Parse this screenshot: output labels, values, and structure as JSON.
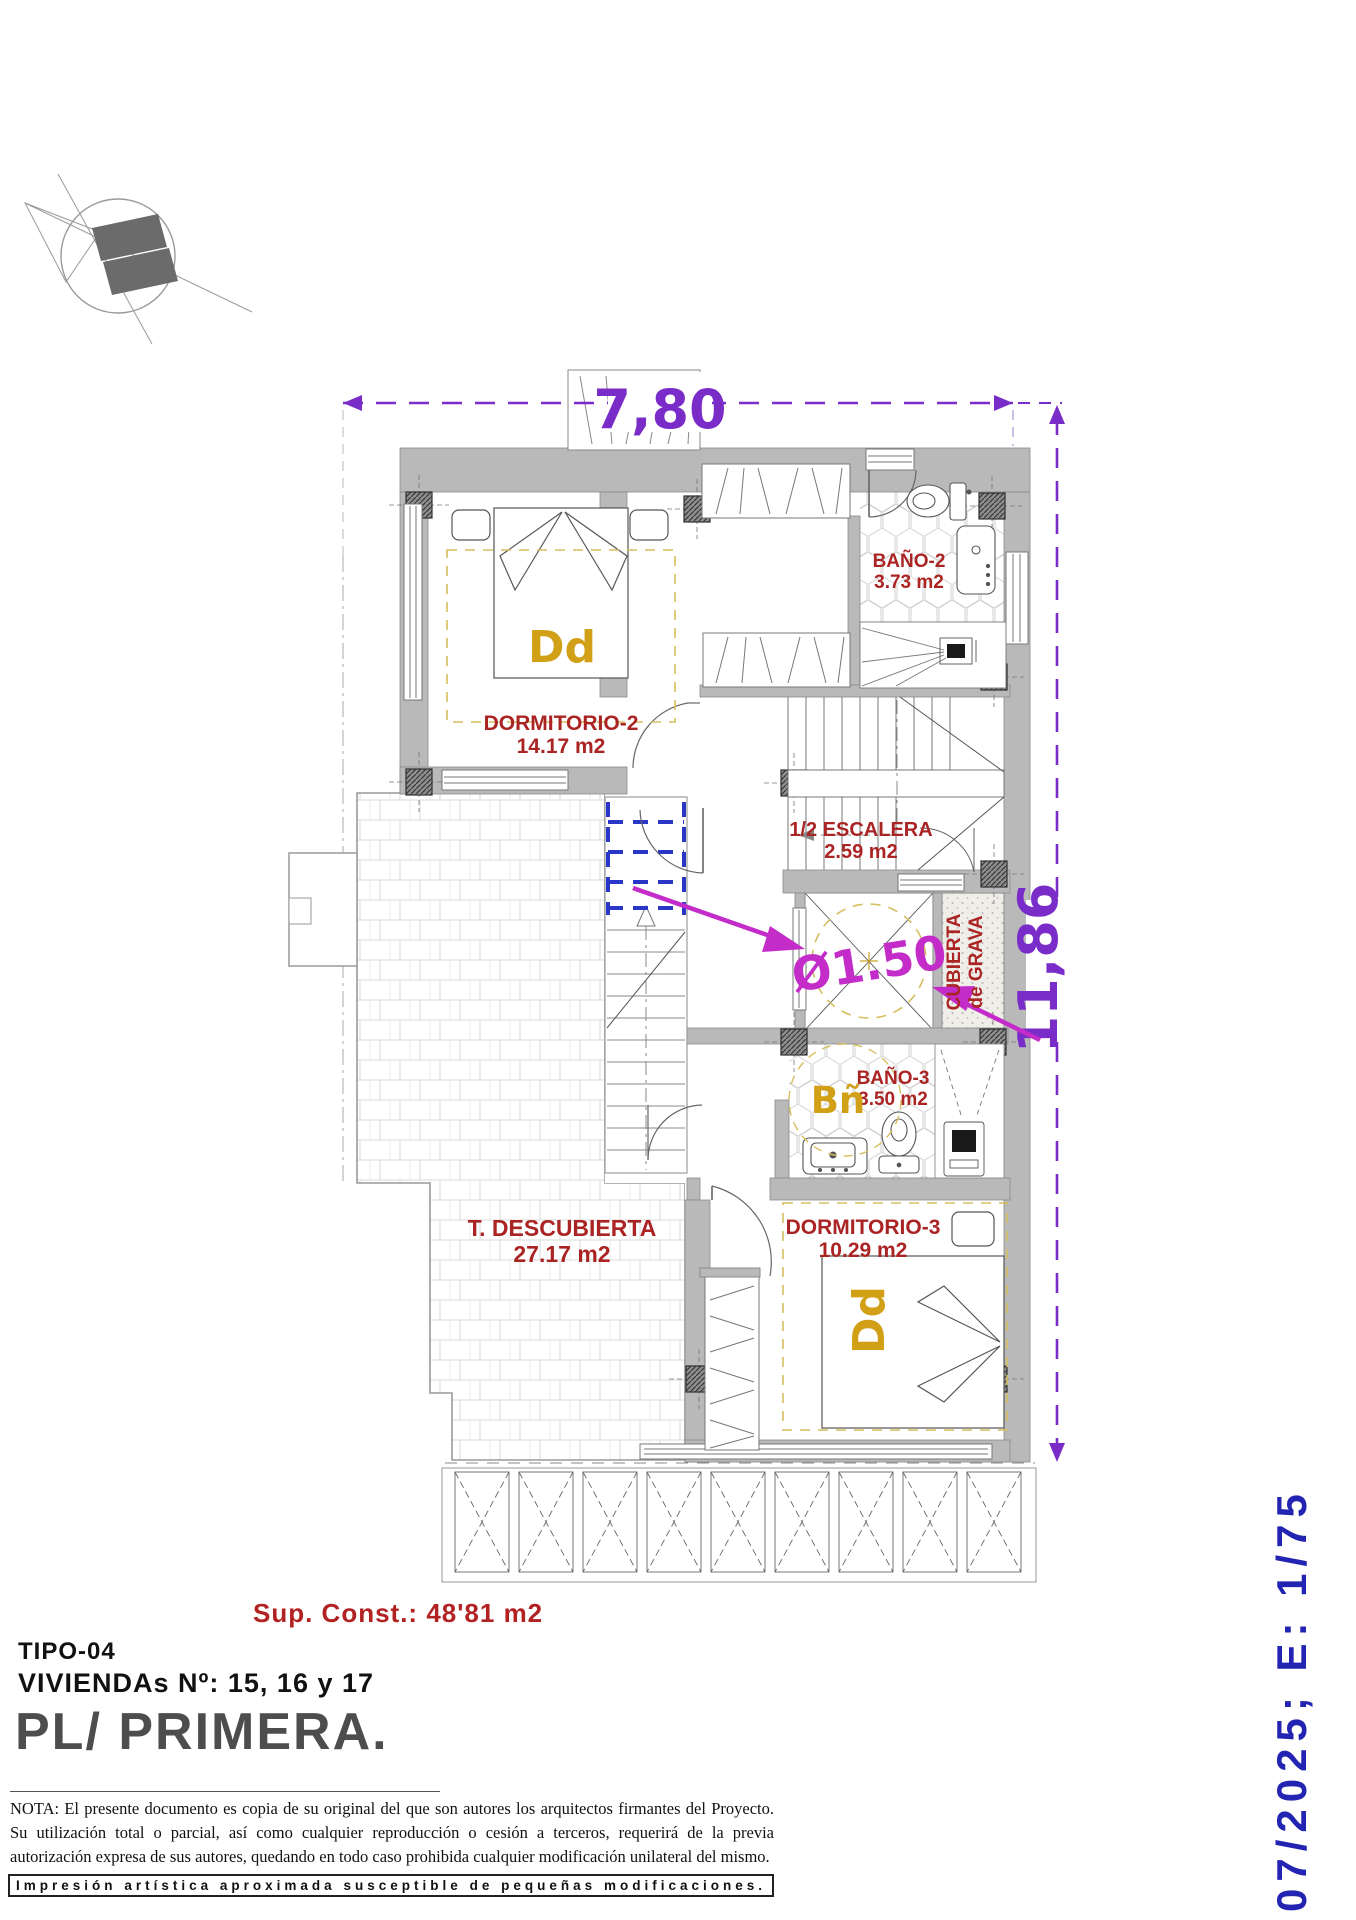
{
  "dimensions": {
    "width": "7,80",
    "height": "11,86",
    "patio_diameter": "Ø1.50"
  },
  "rooms": {
    "dormitorio2": {
      "name": "DORMITORIO-2",
      "area": "14.17 m2",
      "tag": "Dd"
    },
    "bano2": {
      "name": "BAÑO-2",
      "area": "3.73 m2"
    },
    "escalera": {
      "name": "1/2 ESCALERA",
      "area": "2.59 m2"
    },
    "cubierta": {
      "line1": "CUBIERTA",
      "line2": "de GRAVA"
    },
    "bano3": {
      "name": "BAÑO-3",
      "area": "3.50 m2",
      "tag": "Bñ"
    },
    "dormitorio3": {
      "name": "DORMITORIO-3",
      "area": "10.29 m2",
      "tag": "Dd"
    },
    "terraza": {
      "name": "T. DESCUBIERTA",
      "area": "27.17 m2"
    }
  },
  "titleblock": {
    "sup_const": "Sup. Const.: 48'81 m2",
    "tipo": "TIPO-04",
    "viviendas": "VIVIENDAs Nº: 15, 16 y 17",
    "planta": "PL/ PRIMERA.",
    "date_scale": "07/2025; E: 1/75"
  },
  "nota": "NOTA: El presente documento es copia de su original del que son autores los arquitectos firmantes del Proyecto. Su utilización total o parcial, así como cualquier reproducción o cesión a terceros, requerirá  de la previa autorización expresa de sus autores, quedando en todo caso prohibida cualquier modificación unilateral del mismo.",
  "disclaimer": "Impresión artística aproximada susceptible de pequeñas modificaciones.",
  "colors": {
    "dimension": "#7a2cc9",
    "leader": "#c32cc9",
    "room_label": "#ab2424",
    "tag": "#d2a017",
    "scale_text": "#2424b2",
    "wall": "#b9b9b9"
  }
}
